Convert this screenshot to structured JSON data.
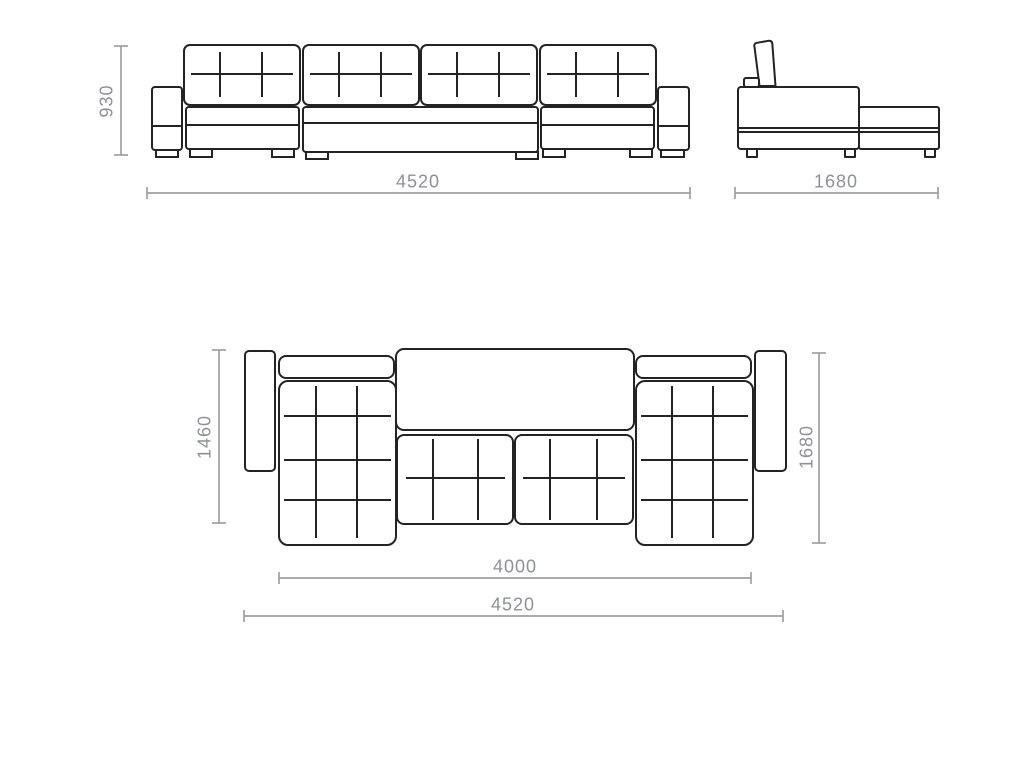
{
  "drawing_title": "sectional-sofa-technical-drawing",
  "colors": {
    "outline": "#232323",
    "dimension_line": "#9d9fa1",
    "dimension_text": "#8e9194",
    "background": "#ffffff"
  },
  "views": {
    "front": {
      "name": "front elevation",
      "height_mm": "930",
      "width_mm": "4520"
    },
    "side": {
      "name": "side elevation",
      "depth_mm": "1680"
    },
    "plan": {
      "name": "plan view",
      "chaise_length_mm": "1460",
      "depth_mm": "1680",
      "seat_width_mm": "4000",
      "overall_width_mm": "4520"
    }
  }
}
